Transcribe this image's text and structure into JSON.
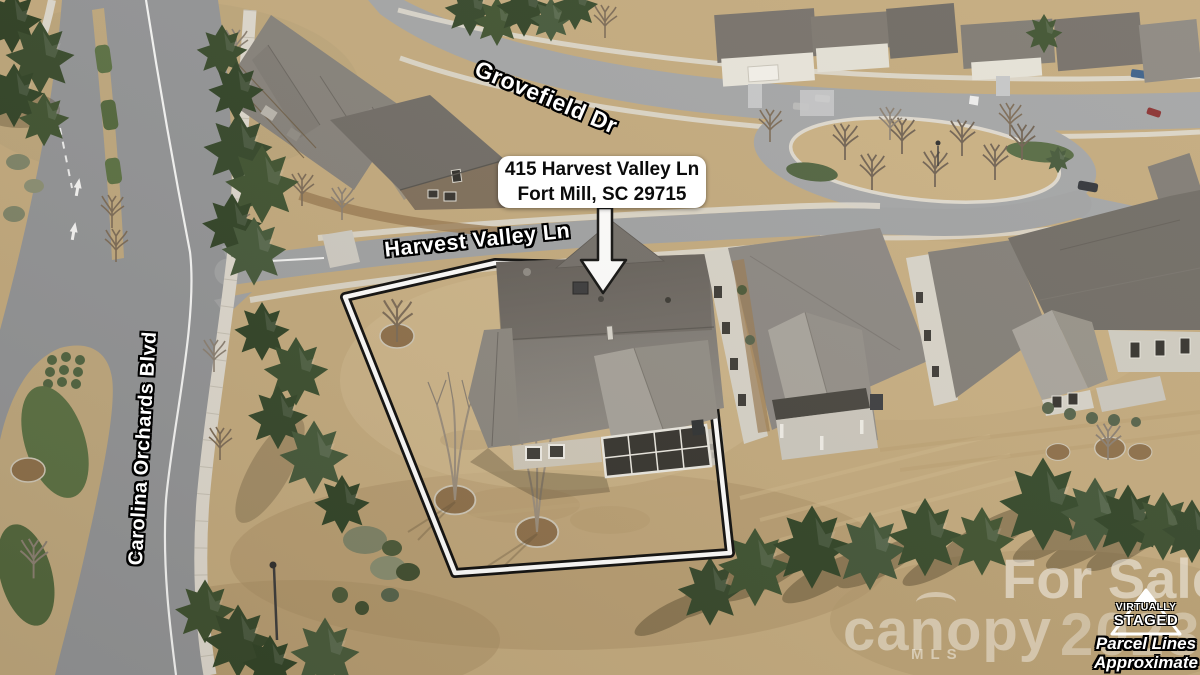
{
  "annotations": {
    "address_card": {
      "line1": "415 Harvest Valley Ln",
      "line2": "Fort Mill, SC 29715"
    },
    "street_labels": {
      "grovefield": "Grovefield Dr",
      "harvest_valley": "Harvest Valley Ln",
      "carolina_orchards": "Carolina Orchards Blvd"
    },
    "watermarks": {
      "for_sale": "For Sale",
      "brand": "canopy",
      "brand_sub": "MLS",
      "year": "2023",
      "badge_line1": "VIRTUALLY",
      "badge_line2": "STAGED",
      "disclaimer_line1": "Parcel Lines",
      "disclaimer_line2": "Approximate"
    }
  },
  "colors": {
    "lawn": "#c3aa7e",
    "road": "#929497",
    "road_light": "#a3a5a7",
    "sidewalk": "#ded9cf",
    "roof_dark": "#6b6762",
    "roof_light": "#928e88",
    "evergreen": "#3c5130",
    "parcel_line": "#ffffff",
    "parcel_line_outline": "#0d0d0d",
    "callout_bg": "#ffffff",
    "callout_text": "#0b0b0b",
    "label_text": "#ffffff",
    "watermark": "#ffffff"
  }
}
